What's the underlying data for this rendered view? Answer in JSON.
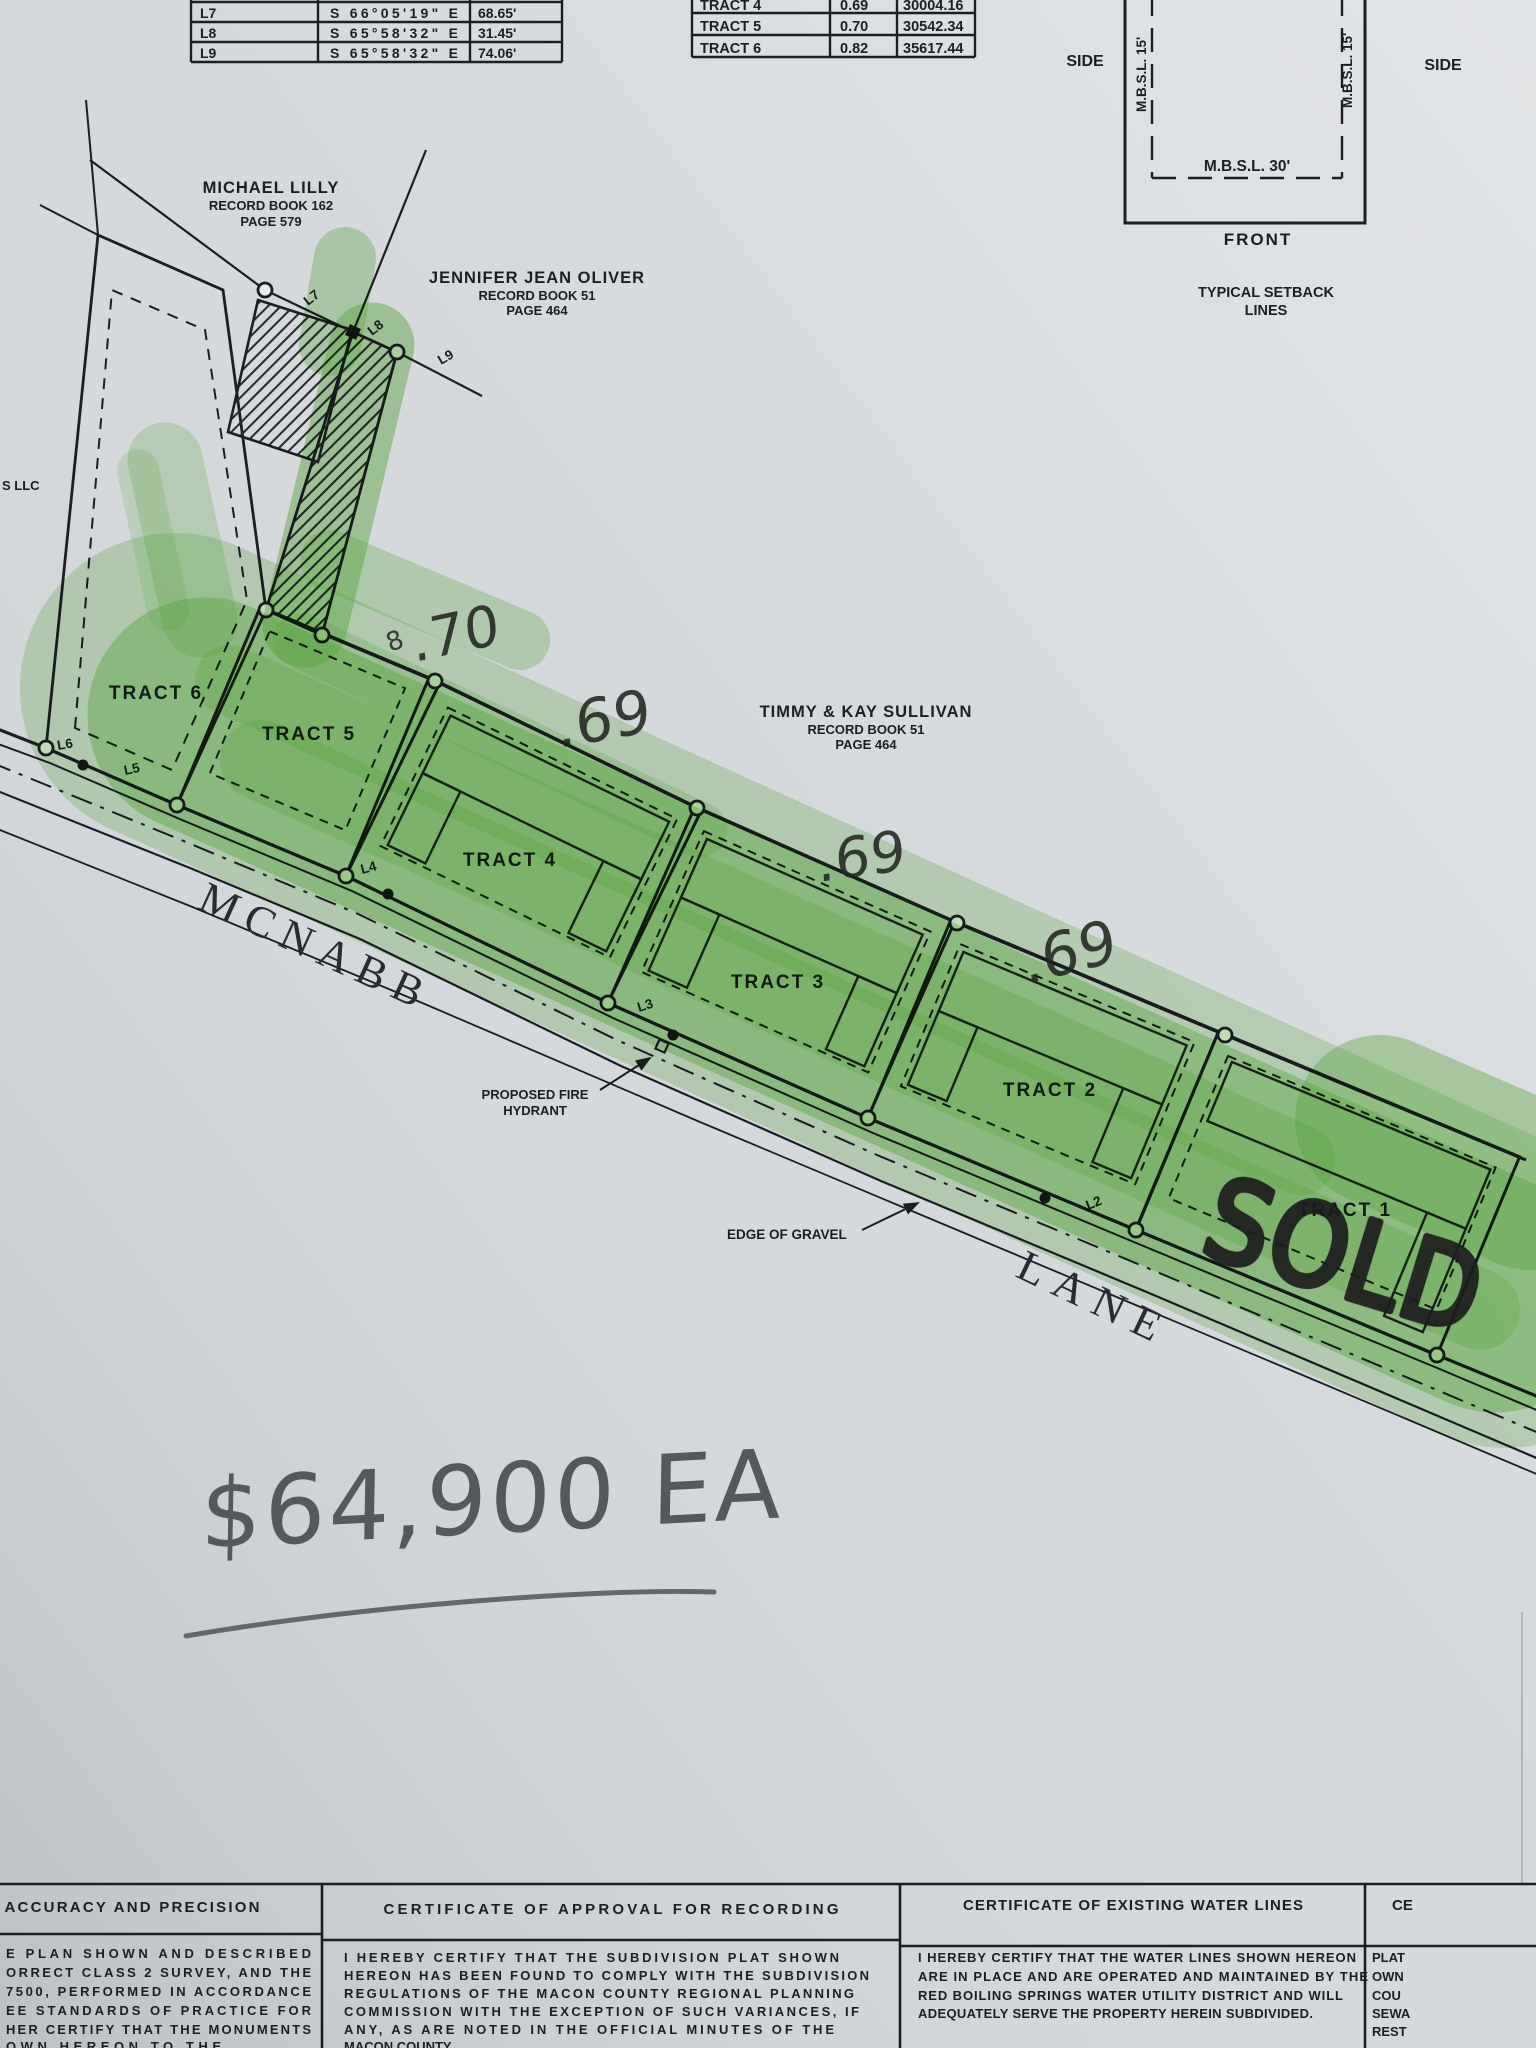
{
  "line_table": {
    "rows": [
      {
        "id": "L7",
        "bearing": "S 66°05'19\" E",
        "distance": "68.65'"
      },
      {
        "id": "L8",
        "bearing": "S 65°58'32\" E",
        "distance": "31.45'"
      },
      {
        "id": "L9",
        "bearing": "S 65°58'32\" E",
        "distance": "74.06'"
      }
    ]
  },
  "tract_table": {
    "rows": [
      {
        "tract": "TRACT 4",
        "acres": "0.69",
        "sq_ft": "30004.16"
      },
      {
        "tract": "TRACT 5",
        "acres": "0.70",
        "sq_ft": "30542.34"
      },
      {
        "tract": "TRACT 6",
        "acres": "0.82",
        "sq_ft": "35617.44"
      }
    ]
  },
  "setback_diagram": {
    "side_left": "SIDE",
    "side_right": "SIDE",
    "mbsl_side_left": "M.B.S.L. 15'",
    "mbsl_side_right": "M.B.S.L. 15'",
    "mbsl_front": "M.B.S.L. 30'",
    "front": "FRONT",
    "caption_line1": "TYPICAL SETBACK",
    "caption_line2": "LINES"
  },
  "map": {
    "owners": [
      {
        "name": "MICHAEL LILLY",
        "book": "RECORD BOOK 162",
        "page": "PAGE 579"
      },
      {
        "name": "JENNIFER JEAN OLIVER",
        "book": "RECORD BOOK 51",
        "page": "PAGE 464"
      },
      {
        "name": "TIMMY & KAY SULLIVAN",
        "book": "RECORD BOOK 51",
        "page": "PAGE 464"
      }
    ],
    "tract_labels": [
      "TRACT 1",
      "TRACT 2",
      "TRACT 3",
      "TRACT 4",
      "TRACT 5",
      "TRACT 6"
    ],
    "point_labels": [
      "L2",
      "L3",
      "L4",
      "L5",
      "L6",
      "L7",
      "L8",
      "L9"
    ],
    "road_name": {
      "first": "MCNABB",
      "second": "LANE"
    },
    "callouts": {
      "fire_hydrant_line1": "PROPOSED FIRE",
      "fire_hydrant_line2": "HYDRANT",
      "edge_of_gravel": "EDGE OF GRAVEL"
    },
    "edge_fragment": "S LLC"
  },
  "handwriting": {
    "price": "$64,900 EA",
    "sold": "SOLD",
    "acreage_marks": [
      ".70",
      ".69",
      ".69",
      ".69"
    ],
    "stray_mark": "8"
  },
  "certificates": {
    "accuracy": {
      "title": "ACCURACY AND PRECISION",
      "lines": [
        "E PLAN SHOWN AND DESCRIBED",
        "ORRECT CLASS 2 SURVEY, AND THE",
        "7500, PERFORMED IN ACCORDANCE",
        "EE STANDARDS OF PRACTICE FOR",
        "HER CERTIFY THAT THE MONUMENTS",
        "OWN HEREON TO THE"
      ]
    },
    "approval": {
      "title": "CERTIFICATE OF APPROVAL FOR RECORDING",
      "lines": [
        "I HEREBY CERTIFY THAT THE SUBDIVISION PLAT SHOWN",
        "HEREON HAS BEEN FOUND TO COMPLY WITH THE SUBDIVISION",
        "REGULATIONS OF THE MACON COUNTY REGIONAL PLANNING",
        "COMMISSION WITH THE EXCEPTION OF SUCH VARIANCES, IF",
        "ANY, AS ARE NOTED IN THE OFFICIAL MINUTES OF THE",
        "MACON COUNTY"
      ]
    },
    "water": {
      "title": "CERTIFICATE OF EXISTING WATER LINES",
      "lines": [
        "I HEREBY CERTIFY THAT THE WATER LINES SHOWN HEREON",
        "ARE IN PLACE AND ARE OPERATED AND MAINTAINED BY THE",
        "RED BOILING SPRINGS WATER UTILITY DISTRICT AND WILL",
        "ADEQUATELY SERVE THE PROPERTY HEREIN SUBDIVIDED."
      ]
    },
    "right_edge": {
      "title_fragment": "CE",
      "lines": [
        "PLAT",
        "OWN",
        "COU",
        "SEWA",
        "REST"
      ]
    }
  },
  "colors": {
    "paper": "#d5d9dc",
    "ink": "#1b1e24",
    "highlighter": "#69bf45",
    "pencil": "#4a4f55",
    "marker": "#1d1d1d",
    "pen": "#20261f"
  }
}
